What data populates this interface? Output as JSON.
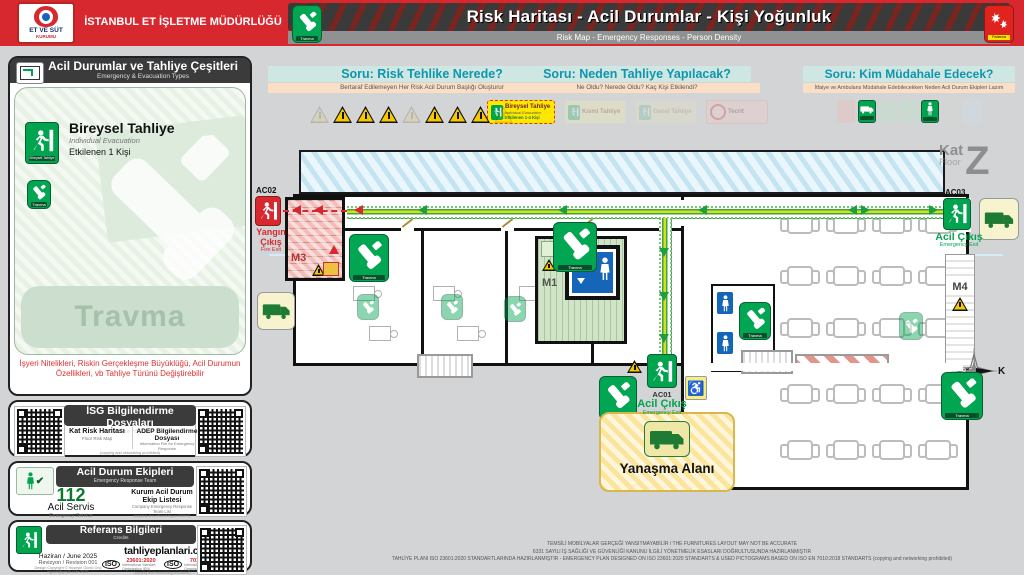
{
  "header": {
    "logo_line1": "ET VE SÜT",
    "logo_line2": "KURUMU",
    "org_title": "İSTANBUL ET İŞLETME MÜDÜRLÜĞÜ",
    "title": "Risk Haritası - Acil Durumlar - Kişi Yoğunluk",
    "subtitle": "Risk Map - Emergency Responses - Person Density",
    "left_icon_label": "Travma",
    "right_icon_label": "Patlama"
  },
  "sidebar": {
    "evacuation_panel": {
      "title": "Acil Durumlar ve Tahliye Çeşitleri",
      "subtitle": "Emergency & Evacuation Types",
      "type_title": "Bireysel Tahliye",
      "type_subtitle": "Individual Evacuation",
      "affected": "Etkilenen 1 Kişi",
      "exit_badge": "Bireysel Tahliye",
      "watermark": "Travma",
      "note": "İşyeri Nitelikleri, Riskin Gerçekleşme Büyüklüğü, Acil Durumun Özellikleri, vb Tahliye Türünü Değiştirebilir"
    },
    "hse_panel": {
      "title": "İSG Bilgilendirme Dosyaları",
      "subtitle": "Information HSE Files",
      "item1_title": "Kat Risk Haritası",
      "item1_sub": "Floor Risk Map",
      "item2_title": "ADEP Bilgilendirme Dosyası",
      "item2_sub": "Information File for Emergency Response",
      "note": "(copying and networking prohibited)"
    },
    "team_panel": {
      "title": "Acil Durum Ekipleri",
      "subtitle": "Emergency Response Team",
      "phone": "112",
      "phone_label": "Acil Servis",
      "phone_sub": "Emergency Service",
      "list_title": "Kurum Acil Durum Ekip Listesi",
      "list_sub": "Company Emergency Response Team List",
      "note": "(copying and networking prohibited)"
    },
    "credits_panel": {
      "title": "Referans Bilgileri",
      "subtitle": "Credits",
      "date": "Haziran / June 2025",
      "revision": "Revizyon / Revision 001",
      "copyright": "Design Copyright © Hüseyin Günlü Orçi",
      "email": "hgdoti@gmail.com 2025",
      "website": "tahliyeplanlari.com",
      "iso_label": "ISO",
      "iso1_num": "23601:2020",
      "iso2_num": "7010:2018",
      "iso_sub": "International Standart Organization (EN)",
      "note": "(copying and networking prohibited)"
    }
  },
  "questions": {
    "q1": {
      "title": "Soru: Risk Tehlike Nerede?",
      "subtitle": "Bertaraf Edilemeyen Her Risk Acil Durum Başlığı Oluşturur"
    },
    "q2": {
      "title": "Soru: Neden Tahliye Yapılacak?",
      "subtitle": "Ne Oldu? Nerede Oldu? Kaç Kişi Etkilendi?",
      "badge_title": "Bireysel Tahliye",
      "badge_sub": "Individual Evacuation",
      "badge_line": "Etkilenen 1-4 Kişi",
      "faded1": "Kısmi Tahliye",
      "faded2": "Genel Tahliye",
      "faded3": "Tecrit"
    },
    "q3": {
      "title": "Soru: Kim Müdahale Edecek?",
      "subtitle": "İtfaiye ve Ambulans Müdahale Edebilecekken Neden Acil Durum Ekipleri Lazım"
    }
  },
  "plan": {
    "floor_label": "Kat",
    "floor_label_en": "Floor",
    "floor_letter": "Z",
    "exits": {
      "ac01": {
        "code": "AC01",
        "label": "Acil Çıkış",
        "en": "Emergency Exit"
      },
      "ac02": {
        "code": "AC02",
        "label": "Yangın Çıkış",
        "en": "Fire Exit"
      },
      "ac03": {
        "code": "AC03",
        "label": "Acil Çıkış",
        "en": "Emergency Exit"
      }
    },
    "stairs": {
      "m1": "M1",
      "m3": "M3",
      "m4": "M4"
    },
    "assembly_label": "Yanaşma Alanı",
    "compass_label": "K",
    "travma_label": "Travma"
  },
  "icons": {
    "wheelchair": "♿",
    "check": "✔"
  },
  "footer": {
    "line1": "TEMSİLİ MOBİLYALAR GERÇEĞİ YANSITMAYABİLİR / THE FURNITURES LAYOUT MAY NOT BE ACCURATE",
    "line2": "6331 SAYILI İŞ SAĞLIĞI VE GÜVENLİĞİ KANUNU İLGİLİ YÖNETMELİK ESASLARI DOĞRULTUSUNDA HAZIRLANMIŞTIR",
    "line3": "TAHLİYE PLANI ISO 23601:2020 STANDARTLARINDA HAZIRLANMIŞTIR - EMERGENCY PLAN DESIGNED ON ISO 23601:2020 STANDARTS & USED PICTOGRAMS BASED ON ISO EN 7010:2018 STANDARTS (copying and networking prohibited)"
  },
  "colors": {
    "brand_red": "#d7282f",
    "safety_green": "#00a44e",
    "route_green": "#39a83b",
    "teal": "#0f95ad",
    "assembly_yellow": "#f2d372"
  }
}
